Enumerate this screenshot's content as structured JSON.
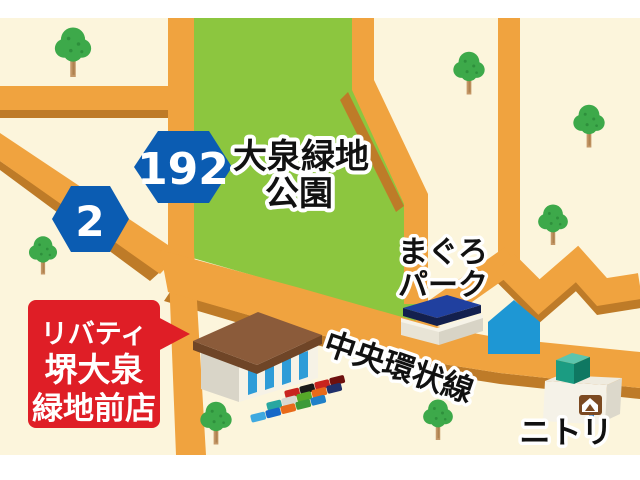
{
  "map_title": "リバティ堺大泉緑地前店 周辺地図",
  "badges": {
    "route_192": "192",
    "route_2": "2"
  },
  "labels": {
    "park_line1": "大泉緑地",
    "park_line2": "公園",
    "maguro_line1": "まぐろ",
    "maguro_line2": "パーク",
    "ring_road": "中央環状線",
    "nitori": "ニトリ"
  },
  "callout": {
    "line1": "リバティ",
    "line2": "堺大泉",
    "line3": "緑地前店"
  },
  "colors": {
    "background_cream": "#FCF5DC",
    "frame_white": "#FFFFFF",
    "park_green": "#8CC63F",
    "road_orange": "#F0A33F",
    "road_shadow_brown": "#BE7B28",
    "route_badge_blue": "#0B5CB2",
    "callout_red": "#DF1E26",
    "callout_text": "#FFFFFF",
    "store_roof_brown": "#8B5B3A",
    "window_blue": "#2E9CD8",
    "maguro_roof_blue": "#20409F",
    "pond_house_blue": "#1E97D4",
    "nitori_teal": "#1B9C82",
    "tree_green": "#3DA94A"
  },
  "parking": {
    "rows": [
      {
        "x": 284,
        "y": 391,
        "colors": [
          "#C8241E",
          "#1A1A1A",
          "#C8241E",
          "#6E100E"
        ]
      },
      {
        "x": 266,
        "y": 403,
        "colors": [
          "#28A7A0",
          "#D8D8D0",
          "#56A829",
          "#E86A1A",
          "#20306A"
        ]
      },
      {
        "x": 250,
        "y": 415,
        "colors": [
          "#3FA9E0",
          "#1668C8",
          "#E86A1A",
          "#3C9A38",
          "#2080C8"
        ]
      }
    ]
  }
}
